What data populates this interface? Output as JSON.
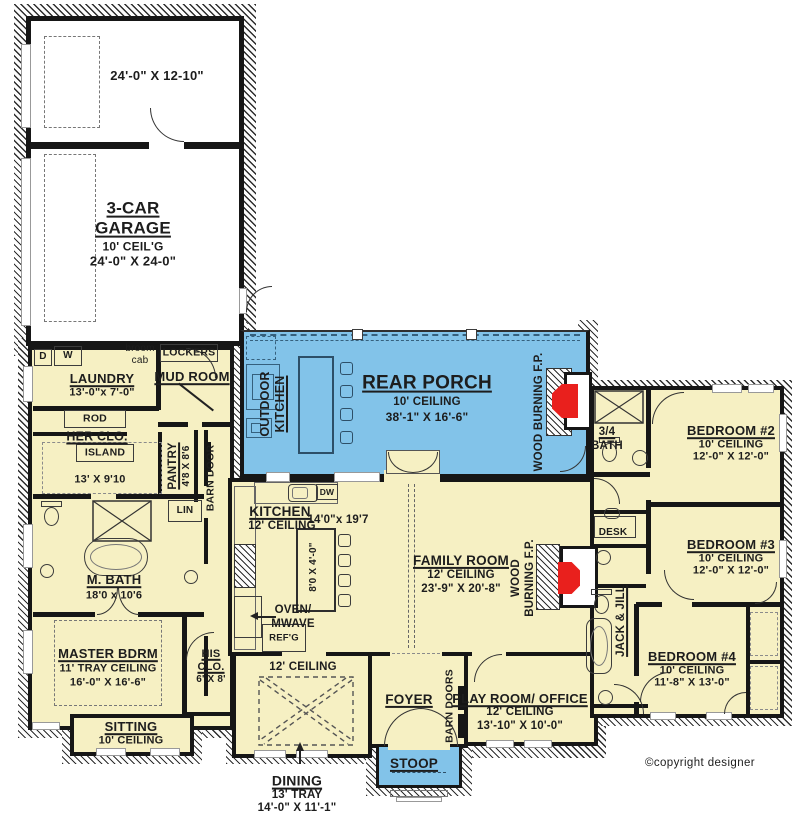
{
  "colors": {
    "room_fill": "#f6f0c3",
    "porch_fill": "#82c3e9",
    "fireplace_red": "#e9201d",
    "wall": "#161616"
  },
  "garage": {
    "upper_dims": "24'-0\" X 12-10\"",
    "name_l1": "3-CAR",
    "name_l2": "GARAGE",
    "ceiling": "10' CEIL'G",
    "dims": "24'-0\" X 24-0\""
  },
  "porch": {
    "name": "REAR PORCH",
    "ceiling": "10' CEILING",
    "dims": "38'-1\" X 16'-6\"",
    "outdoor_kitchen_l1": "OUTDOOR",
    "outdoor_kitchen_l2": "KITCHEN",
    "fireplace": "WOOD BURNING F.P."
  },
  "laundry": {
    "name": "LAUNDRY",
    "dims": "13'-0\"x 7'-0\"",
    "dryer": "D",
    "washer": "W",
    "broom_l1": "broom",
    "broom_l2": "cab"
  },
  "mudroom": {
    "name": "MUD ROOM",
    "lockers": "LOCKERS"
  },
  "her_closet": {
    "name": "HER CLO.",
    "island": "ISLAND",
    "dims": "13' X 9'10",
    "rod": "ROD"
  },
  "pantry": {
    "name": "PANTRY",
    "dims": "4'8 X 8'6"
  },
  "barn_door": {
    "label": "BARN DOOR"
  },
  "linen": {
    "label": "LIN"
  },
  "master_bath": {
    "name": "M. BATH",
    "dims": "18'0 x 10'6"
  },
  "master_bedroom": {
    "name": "MASTER BDRM",
    "ceiling": "11' TRAY CEILING",
    "dims": "16'-0\" X 16'-6\""
  },
  "sitting": {
    "name": "SITTING",
    "ceiling": "10' CEILING"
  },
  "his_closet": {
    "name_l1": "HIS",
    "name_l2": "CLO.",
    "dims": "6' X 8'"
  },
  "kitchen": {
    "name": "KITCHEN",
    "ceiling": "12' CEILING",
    "dims": "14'0\"x 19'7",
    "island_dims": "8'0 X 4'-0\"",
    "oven_l1": "OVEN/",
    "oven_l2": "MWAVE",
    "fridge": "REF'G",
    "dishwasher": "DW"
  },
  "family_room": {
    "name": "FAMILY ROOM",
    "ceiling": "12' CEILING",
    "dims": "23'-9\" X 20'-8\"",
    "fireplace_l1": "WOOD",
    "fireplace_l2": "BURNING F.P."
  },
  "dining": {
    "name": "DINING",
    "ceiling": "13' TRAY",
    "dims": "14'-0\" X 11'-1\"",
    "note": "12' CEILING"
  },
  "foyer": {
    "name": "FOYER",
    "barn_doors": "BARN DOORS"
  },
  "stoop": {
    "name": "STOOP"
  },
  "playroom": {
    "name": "PLAY ROOM/ OFFICE",
    "ceiling": "12' CEILING",
    "dims": "13'-10\" X 10'-0\""
  },
  "bath_34": {
    "name_l1": "3/4",
    "name_l2": "BATH"
  },
  "bedroom2": {
    "name": "BEDROOM #2",
    "ceiling": "10' CEILING",
    "dims": "12'-0\" X 12'-0\""
  },
  "bedroom3": {
    "name": "BEDROOM #3",
    "ceiling": "10' CEILING",
    "dims": "12'-0\" X 12'-0\""
  },
  "bedroom4": {
    "name": "BEDROOM #4",
    "ceiling": "10' CEILING",
    "dims": "11'-8\" X 13'-0\""
  },
  "jack_jill": {
    "label": "JACK & JILL",
    "desk": "DESK"
  },
  "meta": {
    "copyright": "©copyright designer"
  }
}
